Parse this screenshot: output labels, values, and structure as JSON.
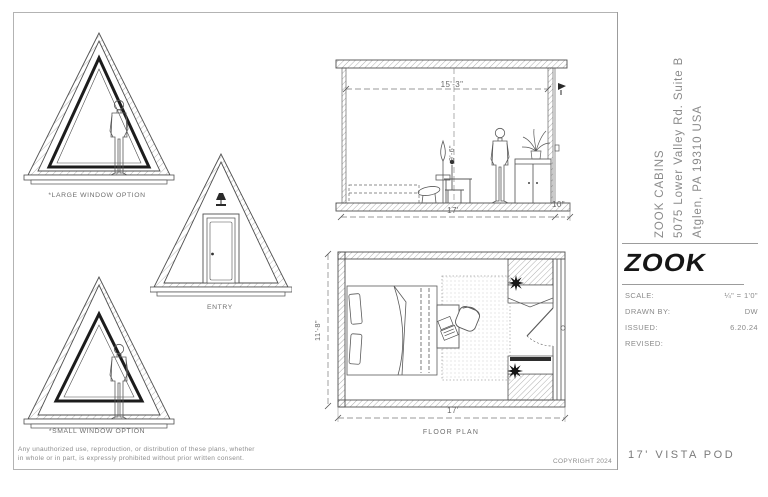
{
  "sheet": {
    "elevations": {
      "large_window_label": "*LARGE WINDOW OPTION",
      "entry_label": "ENTRY",
      "small_window_label": "*SMALL WINDOW OPTION"
    },
    "section": {
      "width_dim": "15'-3\"",
      "height_dim": "9'-6\"",
      "base_dim": "17'",
      "overhang_dim": "10\""
    },
    "floor_plan": {
      "label": "FLOOR PLAN",
      "depth_dim": "11'-8\"",
      "width_dim": "17'"
    }
  },
  "title_block": {
    "company_name": "ZOOK CABINS",
    "address_line1": "5075 Lower Valley Rd. Suite B",
    "address_line2": "Atglen, PA 19310 USA",
    "logo_text": "ZOOK",
    "fields": [
      {
        "label": "SCALE:",
        "value": "¼\" = 1'0\""
      },
      {
        "label": "DRAWN BY:",
        "value": "DW"
      },
      {
        "label": "ISSUED:",
        "value": "6.20.24"
      },
      {
        "label": "REVISED:",
        "value": ""
      }
    ],
    "drawing_title": "17' VISTA POD"
  },
  "footer": {
    "disclaimer_line1": "Any unauthorized use, reproduction, or distribution of these plans, whether",
    "disclaimer_line2": "in whole or in part, is expressly prohibited without prior written consent.",
    "copyright": "COPYRIGHT 2024"
  },
  "colors": {
    "line": "#4f4f4f",
    "text_gray": "#7d7d7d",
    "logo_black": "#161616"
  }
}
